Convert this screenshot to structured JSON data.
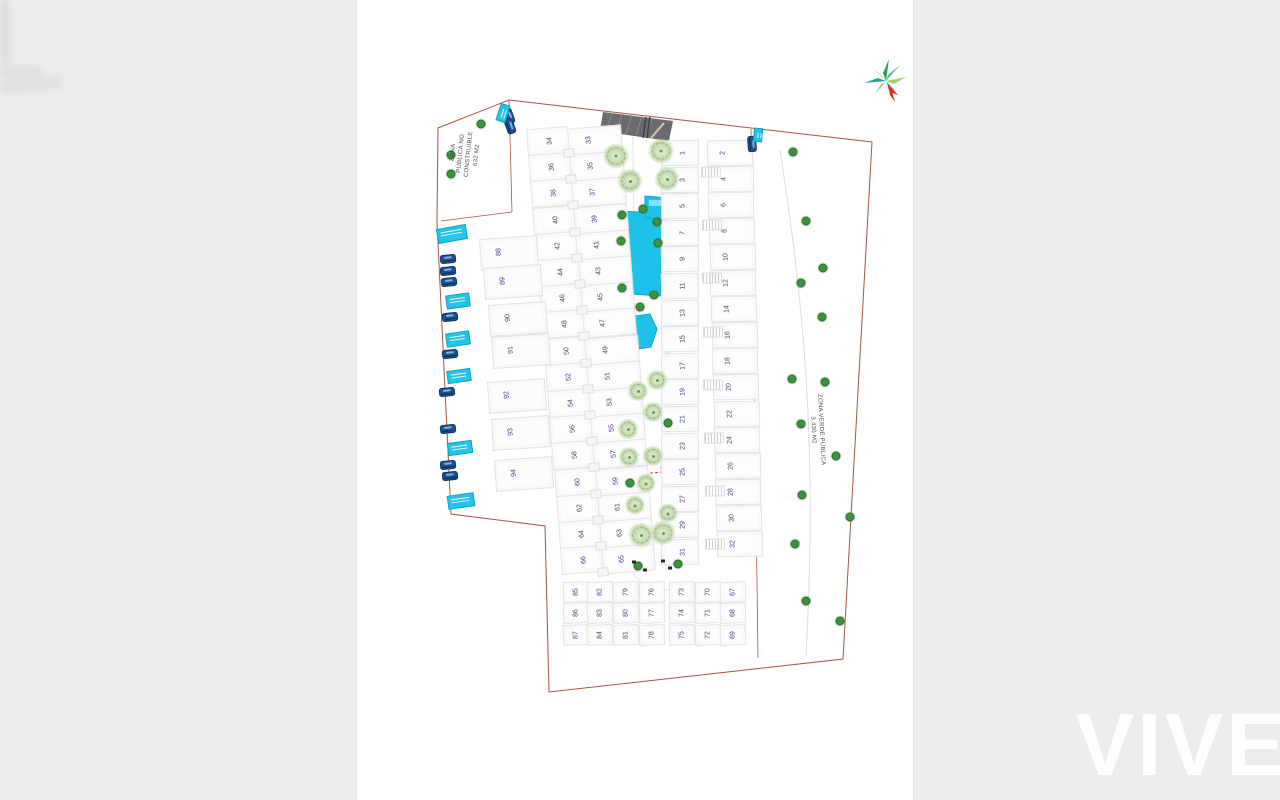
{
  "plan": {
    "zona_publica": {
      "line1": "ZONA",
      "line2": "PÚBLICA NO",
      "line3": "CONSTRUIBLE",
      "line4": "632 M2"
    },
    "zona_verde": {
      "line1": "ZONA VERDE PÚBLICA",
      "line2": "3.430 M2"
    },
    "watermark": "VIVE",
    "plots": {
      "right_odd": [
        "1",
        "3",
        "5",
        "7",
        "9",
        "11",
        "13",
        "15",
        "17",
        "19",
        "21",
        "23",
        "25",
        "27",
        "29",
        "31"
      ],
      "right_even": [
        "2",
        "4",
        "6",
        "8",
        "10",
        "12",
        "14",
        "16",
        "18",
        "20",
        "22",
        "24",
        "26",
        "28",
        "30",
        "32"
      ],
      "center_odd": [
        "33",
        "35",
        "37",
        "39",
        "41",
        "43",
        "45",
        "47",
        "49",
        "51",
        "53",
        "55",
        "57",
        "59",
        "61",
        "63",
        "65"
      ],
      "center_even": [
        "34",
        "36",
        "38",
        "40",
        "42",
        "44",
        "46",
        "48",
        "50",
        "52",
        "54",
        "56",
        "58",
        "60",
        "62",
        "64",
        "66"
      ],
      "bottom_columns": [
        [
          "85",
          "86",
          "87"
        ],
        [
          "82",
          "83",
          "84"
        ],
        [
          "79",
          "80",
          "81"
        ],
        [
          "76",
          "77",
          "78"
        ],
        [
          "73",
          "74",
          "75"
        ],
        [
          "70",
          "71",
          "72"
        ],
        [
          "67",
          "68",
          "69"
        ]
      ],
      "left_column": [
        "88",
        "89",
        "90",
        "91",
        "92",
        "93",
        "94"
      ]
    },
    "colors": {
      "pool": "#1ec1e8",
      "pool_edge": "#12a3c8",
      "boundary": "#a2563f",
      "tree_dot": "#3f9141",
      "car": "#1d4e8f",
      "label_cyan": "#24c4e8",
      "compass_red": "#d2331c"
    }
  }
}
